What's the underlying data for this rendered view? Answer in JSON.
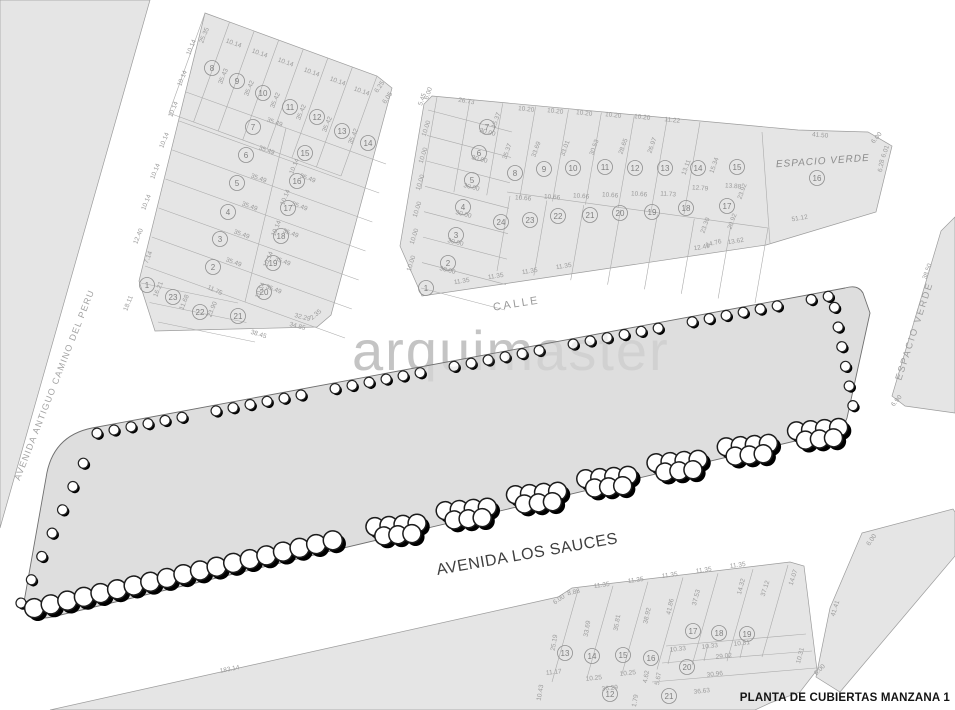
{
  "title": "PLANTA DE CUBIERTAS MANZANA 1",
  "watermark": "arquimaster",
  "streets": {
    "left": "AVENIDA ANTIGUO CAMINO DEL PERU",
    "middle": "CALLE",
    "bottom": "AVENIDA LOS SAUCES"
  },
  "green_labels": {
    "top": "ESPACIO VERDE",
    "right": "ESPACIO VERDE"
  },
  "colors": {
    "block_fill": "#e5e5e5",
    "block_stroke": "#9c9c9c",
    "lot_line": "#ababab",
    "strip_fill": "#dedede",
    "strip_stroke": "#6f6f6f",
    "roof_black": "#0c0c0c",
    "roof_gray": "#c3c3c3",
    "slab_gray": "#a8a8a8",
    "mid_band": "#d4d4d4",
    "mid_box": "#b5b5b5",
    "patio_gray": "#c8c8c8",
    "tree_stroke": "#1c1c1c",
    "shadow": "#000000"
  },
  "blocks": {
    "top_left": {
      "lots": [
        [
          "8",
          212,
          68
        ],
        [
          "9",
          237,
          81
        ],
        [
          "10",
          263,
          93
        ],
        [
          "11",
          290,
          107
        ],
        [
          "12",
          317,
          117
        ],
        [
          "13",
          342,
          131
        ],
        [
          "14",
          368,
          143
        ],
        [
          "7",
          253,
          127
        ],
        [
          "6",
          246,
          155
        ],
        [
          "5",
          237,
          183
        ],
        [
          "4",
          228,
          212
        ],
        [
          "3",
          220,
          239
        ],
        [
          "2",
          213,
          267
        ],
        [
          "1",
          147,
          285
        ],
        [
          "15",
          305,
          153
        ],
        [
          "16",
          297,
          181
        ],
        [
          "17",
          288,
          208
        ],
        [
          "18",
          281,
          236
        ],
        [
          "19",
          273,
          263
        ],
        [
          "20",
          264,
          292
        ],
        [
          "23",
          173,
          297
        ],
        [
          "22",
          200,
          312
        ],
        [
          "21",
          238,
          316
        ]
      ],
      "dims": [
        [
          "25.35",
          206,
          36,
          -68
        ],
        [
          "10.14",
          233,
          45,
          20
        ],
        [
          "10.14",
          259,
          55,
          20
        ],
        [
          "10.14",
          285,
          64,
          20
        ],
        [
          "10.14",
          311,
          74,
          20
        ],
        [
          "10.14",
          337,
          83,
          20
        ],
        [
          "10.14",
          361,
          93,
          20
        ],
        [
          "6.25",
          381,
          88,
          -55
        ],
        [
          "6.05",
          389,
          99,
          -55
        ],
        [
          "35.43",
          225,
          77,
          -68
        ],
        [
          "35.42",
          251,
          89,
          -68
        ],
        [
          "35.42",
          277,
          101,
          -68
        ],
        [
          "35.42",
          303,
          113,
          -68
        ],
        [
          "35.42",
          329,
          125,
          -68
        ],
        [
          "35.42",
          355,
          137,
          -68
        ],
        [
          "10.14",
          193,
          48,
          -68
        ],
        [
          "10.14",
          184,
          79,
          -68
        ],
        [
          "10.14",
          175,
          110,
          -68
        ],
        [
          "10.14",
          166,
          141,
          -68
        ],
        [
          "10.14",
          157,
          172,
          -68
        ],
        [
          "10.14",
          148,
          203,
          -68
        ],
        [
          "12.40",
          140,
          237,
          -68
        ],
        [
          "7.14",
          150,
          258,
          -68
        ],
        [
          "35.49",
          274,
          124,
          20
        ],
        [
          "35.49",
          266,
          152,
          20
        ],
        [
          "35.49",
          258,
          180,
          20
        ],
        [
          "35.49",
          249,
          208,
          20
        ],
        [
          "35.49",
          241,
          236,
          20
        ],
        [
          "35.49",
          233,
          264,
          20
        ],
        [
          "35.49",
          307,
          180,
          20
        ],
        [
          "35.49",
          299,
          208,
          20
        ],
        [
          "35.49",
          290,
          235,
          20
        ],
        [
          "35.49",
          282,
          263,
          20
        ],
        [
          "35.49",
          273,
          291,
          20
        ],
        [
          "10.14",
          296,
          167,
          -68
        ],
        [
          "10.14",
          287,
          198,
          -68
        ],
        [
          "10.14",
          278,
          229,
          -68
        ],
        [
          "10.14",
          270,
          260,
          -68
        ],
        [
          "10.14",
          262,
          291,
          -68
        ],
        [
          "11.75",
          214,
          292,
          25
        ],
        [
          "16.21",
          160,
          290,
          -68
        ],
        [
          "11.68",
          186,
          303,
          -68
        ],
        [
          "23.90",
          214,
          310,
          -68
        ],
        [
          "38.45",
          258,
          336,
          17
        ],
        [
          "34.85",
          297,
          328,
          15
        ],
        [
          "32.29",
          302,
          319,
          15
        ],
        [
          "2.35",
          317,
          316,
          -40
        ],
        [
          "18.11",
          130,
          304,
          -68
        ]
      ]
    },
    "top_middle": {
      "lots": [
        [
          "1",
          426,
          288
        ],
        [
          "2",
          448,
          263
        ],
        [
          "3",
          456,
          235
        ],
        [
          "4",
          463,
          207
        ],
        [
          "5",
          472,
          180
        ],
        [
          "6",
          479,
          153
        ],
        [
          "7",
          487,
          127
        ],
        [
          "8",
          515,
          173
        ],
        [
          "9",
          544,
          169
        ],
        [
          "10",
          573,
          168
        ],
        [
          "11",
          605,
          167
        ],
        [
          "12",
          635,
          168
        ],
        [
          "13",
          665,
          168
        ],
        [
          "14",
          698,
          168
        ],
        [
          "15",
          737,
          167
        ],
        [
          "16",
          817,
          178
        ],
        [
          "24",
          501,
          222
        ],
        [
          "23",
          530,
          220
        ],
        [
          "22",
          558,
          216
        ],
        [
          "21",
          590,
          215
        ],
        [
          "20",
          620,
          213
        ],
        [
          "19",
          652,
          212
        ],
        [
          "18",
          686,
          208
        ],
        [
          "17",
          727,
          206
        ]
      ],
      "dims": [
        [
          "5.45",
          424,
          100,
          -70
        ],
        [
          "6.00",
          430,
          94,
          -70
        ],
        [
          "26.73",
          466,
          103,
          10
        ],
        [
          "15.37",
          498,
          121,
          -70
        ],
        [
          "10.20",
          526,
          111,
          6
        ],
        [
          "10.20",
          555,
          113,
          6
        ],
        [
          "10.20",
          584,
          115,
          6
        ],
        [
          "10.20",
          613,
          117,
          6
        ],
        [
          "10.20",
          642,
          119,
          6
        ],
        [
          "11.22",
          672,
          122,
          6
        ],
        [
          "30.00",
          447,
          272,
          15
        ],
        [
          "30.00",
          455,
          244,
          15
        ],
        [
          "30.00",
          463,
          216,
          15
        ],
        [
          "30.00",
          471,
          189,
          15
        ],
        [
          "30.00",
          479,
          161,
          15
        ],
        [
          "30.00",
          487,
          134,
          15
        ],
        [
          "10.00",
          413,
          264,
          -72
        ],
        [
          "10.00",
          416,
          237,
          -72
        ],
        [
          "10.00",
          419,
          210,
          -72
        ],
        [
          "10.00",
          422,
          183,
          -72
        ],
        [
          "10.00",
          425,
          156,
          -72
        ],
        [
          "10.00",
          428,
          129,
          -72
        ],
        [
          "35.37",
          509,
          152,
          -70
        ],
        [
          "33.69",
          538,
          150,
          -70
        ],
        [
          "33.01",
          567,
          149,
          -70
        ],
        [
          "30.53",
          596,
          148,
          -70
        ],
        [
          "28.65",
          625,
          147,
          -70
        ],
        [
          "26.97",
          654,
          146,
          -70
        ],
        [
          "10.66",
          523,
          200,
          4
        ],
        [
          "10.66",
          552,
          199,
          4
        ],
        [
          "10.66",
          581,
          198,
          4
        ],
        [
          "10.66",
          610,
          197,
          4
        ],
        [
          "10.66",
          639,
          196,
          4
        ],
        [
          "11.73",
          668,
          196,
          4
        ],
        [
          "11.35",
          462,
          283,
          -9
        ],
        [
          "11.35",
          496,
          278,
          -9
        ],
        [
          "11.35",
          530,
          273,
          -9
        ],
        [
          "11.35",
          564,
          268,
          -9
        ],
        [
          "12.49",
          702,
          249,
          -9
        ],
        [
          "13.62",
          736,
          243,
          -9
        ],
        [
          "41.50",
          820,
          137,
          5
        ],
        [
          "51.12",
          800,
          220,
          -10
        ],
        [
          "6.00",
          878,
          139,
          -50
        ],
        [
          "6.01",
          887,
          152,
          -70
        ],
        [
          "6.28",
          883,
          166,
          -80
        ],
        [
          "13.11",
          688,
          168,
          -70
        ],
        [
          "15.34",
          716,
          166,
          -70
        ],
        [
          "12.79",
          700,
          190,
          4
        ],
        [
          "13.88",
          733,
          188,
          4
        ],
        [
          "23.30",
          707,
          226,
          -70
        ],
        [
          "20.92",
          734,
          222,
          -70
        ],
        [
          "14.76",
          714,
          245,
          -15
        ],
        [
          "23.92",
          744,
          192,
          -70
        ]
      ]
    },
    "bottom": {
      "lots": [
        [
          "12",
          610,
          694
        ],
        [
          "13",
          565,
          653
        ],
        [
          "14",
          592,
          656
        ],
        [
          "15",
          623,
          655
        ],
        [
          "16",
          651,
          658
        ],
        [
          "17",
          693,
          631
        ],
        [
          "18",
          719,
          633
        ],
        [
          "19",
          747,
          634
        ],
        [
          "20",
          687,
          667
        ],
        [
          "21",
          669,
          696
        ]
      ],
      "dims": [
        [
          "183.14",
          230,
          671,
          -11
        ],
        [
          "6.00",
          560,
          601,
          -35
        ],
        [
          "8.88",
          574,
          594,
          -12
        ],
        [
          "11.35",
          602,
          587,
          -8
        ],
        [
          "11.35",
          636,
          582,
          -8
        ],
        [
          "11.35",
          670,
          577,
          -8
        ],
        [
          "11.35",
          704,
          572,
          -8
        ],
        [
          "11.35",
          738,
          567,
          -8
        ],
        [
          "25.19",
          556,
          643,
          -80
        ],
        [
          "33.69",
          589,
          629,
          -80
        ],
        [
          "35.81",
          619,
          623,
          -80
        ],
        [
          "38.92",
          649,
          616,
          -78
        ],
        [
          "41.86",
          672,
          607,
          -78
        ],
        [
          "37.53",
          698,
          598,
          -75
        ],
        [
          "14.32",
          743,
          587,
          -75
        ],
        [
          "37.12",
          767,
          589,
          -72
        ],
        [
          "14.07",
          795,
          578,
          -72
        ],
        [
          "10.33",
          678,
          651,
          -6
        ],
        [
          "10.33",
          710,
          648,
          -6
        ],
        [
          "10.31",
          742,
          645,
          -6
        ],
        [
          "29.02",
          724,
          658,
          -6
        ],
        [
          "30.96",
          715,
          676,
          -6
        ],
        [
          "36.63",
          702,
          693,
          -6
        ],
        [
          "10.31",
          802,
          656,
          -75
        ],
        [
          "10.25",
          594,
          680,
          -6
        ],
        [
          "10.25",
          628,
          675,
          -6
        ],
        [
          "36.29",
          610,
          690,
          -6
        ],
        [
          "11.17",
          554,
          674,
          -6
        ],
        [
          "10.43",
          542,
          693,
          -80
        ],
        [
          "4.62",
          648,
          677,
          -80
        ],
        [
          "5.67",
          660,
          679,
          -80
        ],
        [
          "1.79",
          637,
          701,
          -80
        ]
      ]
    },
    "right_wedge": {
      "lots": [],
      "dims": [
        [
          "38.50",
          929,
          272,
          -70
        ],
        [
          "6.90",
          898,
          402,
          -50
        ]
      ]
    },
    "bottom_right": {
      "lots": [],
      "dims": [
        [
          "6.00",
          873,
          541,
          -55
        ],
        [
          "41.41",
          837,
          609,
          -73
        ],
        [
          "6.00",
          821,
          671,
          -45
        ]
      ]
    }
  }
}
